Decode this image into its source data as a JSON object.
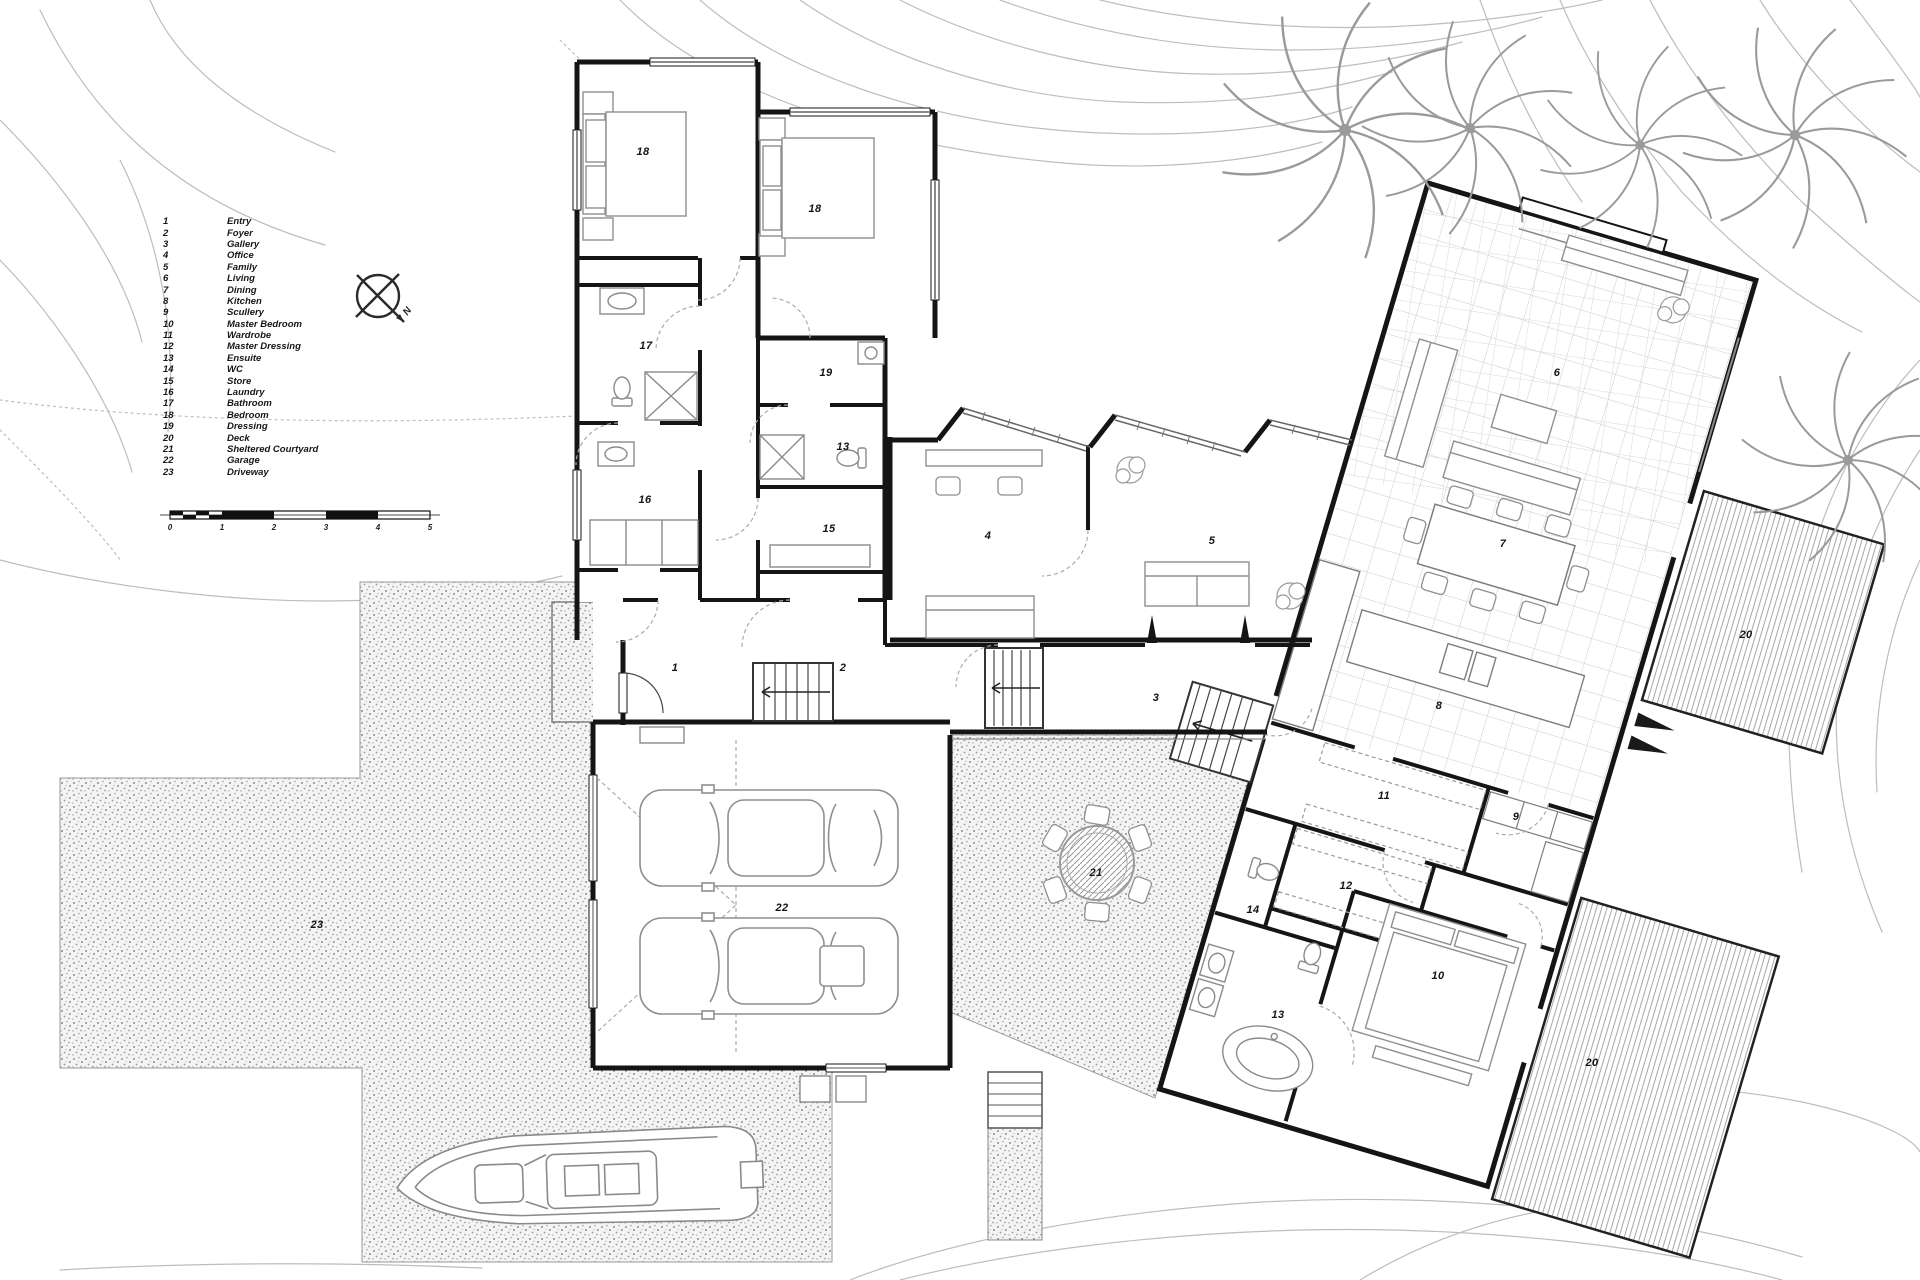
{
  "north_label": "N",
  "legend": {
    "items": [
      {
        "num": "1",
        "label": "Entry"
      },
      {
        "num": "2",
        "label": "Foyer"
      },
      {
        "num": "3",
        "label": "Gallery"
      },
      {
        "num": "4",
        "label": "Office"
      },
      {
        "num": "5",
        "label": "Family"
      },
      {
        "num": "6",
        "label": "Living"
      },
      {
        "num": "7",
        "label": "Dining"
      },
      {
        "num": "8",
        "label": "Kitchen"
      },
      {
        "num": "9",
        "label": "Scullery"
      },
      {
        "num": "10",
        "label": "Master Bedroom"
      },
      {
        "num": "11",
        "label": "Wardrobe"
      },
      {
        "num": "12",
        "label": "Master Dressing"
      },
      {
        "num": "13",
        "label": "Ensuite"
      },
      {
        "num": "14",
        "label": "WC"
      },
      {
        "num": "15",
        "label": "Store"
      },
      {
        "num": "16",
        "label": "Laundry"
      },
      {
        "num": "17",
        "label": "Bathroom"
      },
      {
        "num": "18",
        "label": "Bedroom"
      },
      {
        "num": "19",
        "label": "Dressing"
      },
      {
        "num": "20",
        "label": "Deck"
      },
      {
        "num": "21",
        "label": "Sheltered Courtyard"
      },
      {
        "num": "22",
        "label": "Garage"
      },
      {
        "num": "23",
        "label": "Driveway"
      }
    ]
  },
  "scale_bar": {
    "ticks": [
      "0",
      "1",
      "2",
      "3",
      "4",
      "5"
    ]
  },
  "plan_labels": {
    "entry": "1",
    "foyer": "2",
    "gallery": "3",
    "office": "4",
    "family": "5",
    "living": "6",
    "dining": "7",
    "kitchen": "8",
    "scullery": "9",
    "master_bedroom": "10",
    "wardrobe": "11",
    "master_dressing": "12",
    "ensuite": "13",
    "ensuite_upper": "13",
    "wc": "14",
    "store": "15",
    "laundry": "16",
    "bathroom": "17",
    "bedroom_a": "18",
    "bedroom_b": "18",
    "dressing": "19",
    "deck_upper": "20",
    "deck_lower": "20",
    "sheltered_courtyard": "21",
    "garage": "22",
    "driveway": "23"
  }
}
